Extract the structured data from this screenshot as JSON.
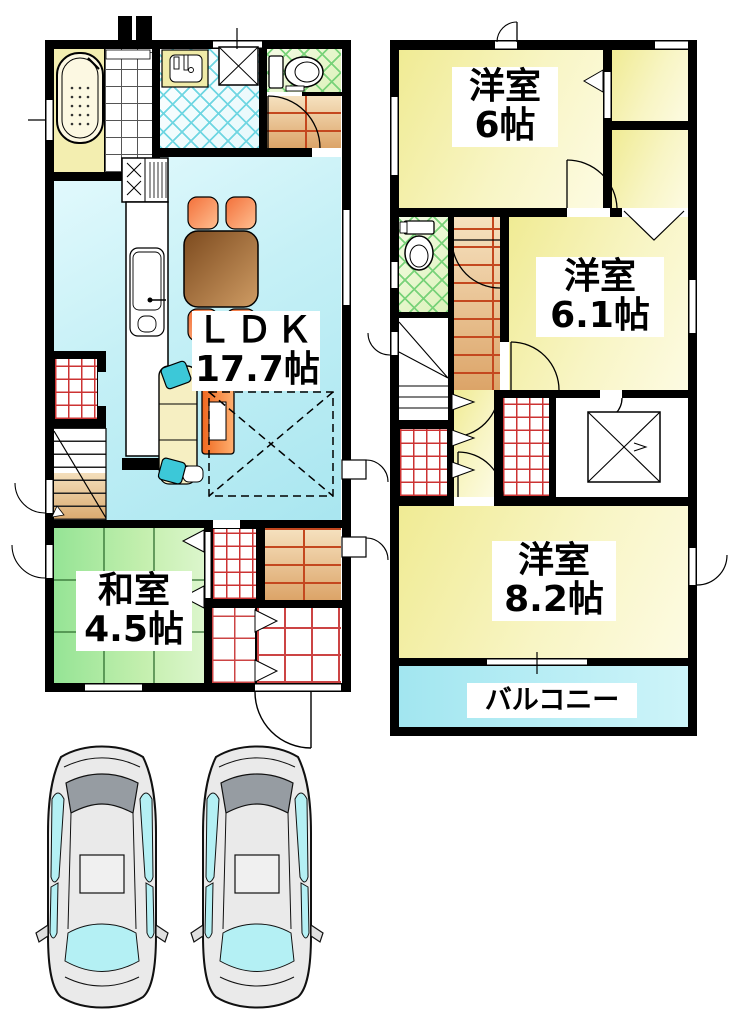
{
  "floor1": {
    "ldk": {
      "name": "ＬＤＫ",
      "size": "17.7帖"
    },
    "washitsu": {
      "name": "和室",
      "size": "4.5帖"
    }
  },
  "floor2": {
    "bedroom_a": {
      "name": "洋室",
      "size": "6帖"
    },
    "bedroom_b": {
      "name": "洋室",
      "size": "6.1帖"
    },
    "bedroom_c": {
      "name": "洋室",
      "size": "8.2帖"
    },
    "balcony": {
      "name": "バルコニー"
    }
  },
  "fixtures": {
    "first_floor": [
      "bathtub-icon",
      "shower-floor-icon",
      "washbasin-icon",
      "washing-machine-icon",
      "toilet-icon",
      "kitchen-counter-icon",
      "gas-stove-icon",
      "kitchen-sink-icon",
      "dining-table-icon",
      "chair-icon",
      "sofa-icon",
      "cushion-icon",
      "tv-icon",
      "staircase-icon",
      "closet-grid-icon",
      "genkan-tile-icon",
      "entry-door-arc-icon",
      "tatami-grid-icon"
    ],
    "second_floor": [
      "toilet-icon",
      "staircase-icon",
      "closet-grid-icon",
      "void-x-icon",
      "door-arc-icon",
      "folding-door-icon",
      "window-icon"
    ],
    "outside": [
      "car-icon",
      "car-icon"
    ]
  },
  "colors": {
    "wall": "#000000",
    "ldk_floor": "#bfeef6",
    "tatami": "#a8e8a0",
    "bedroom_floor": "#f2ee9c",
    "balcony_floor": "#aee8f2",
    "closet_grid": "#cc3333",
    "brick_floor": "#e8c08c",
    "tile_cyan": "#6fd6e2",
    "tile_green": "#79d279",
    "chair": "#f08040",
    "table": "#9a6a38",
    "tv": "#f07830",
    "car_body": "#eaeaea",
    "car_window": "#b4f0f4"
  }
}
